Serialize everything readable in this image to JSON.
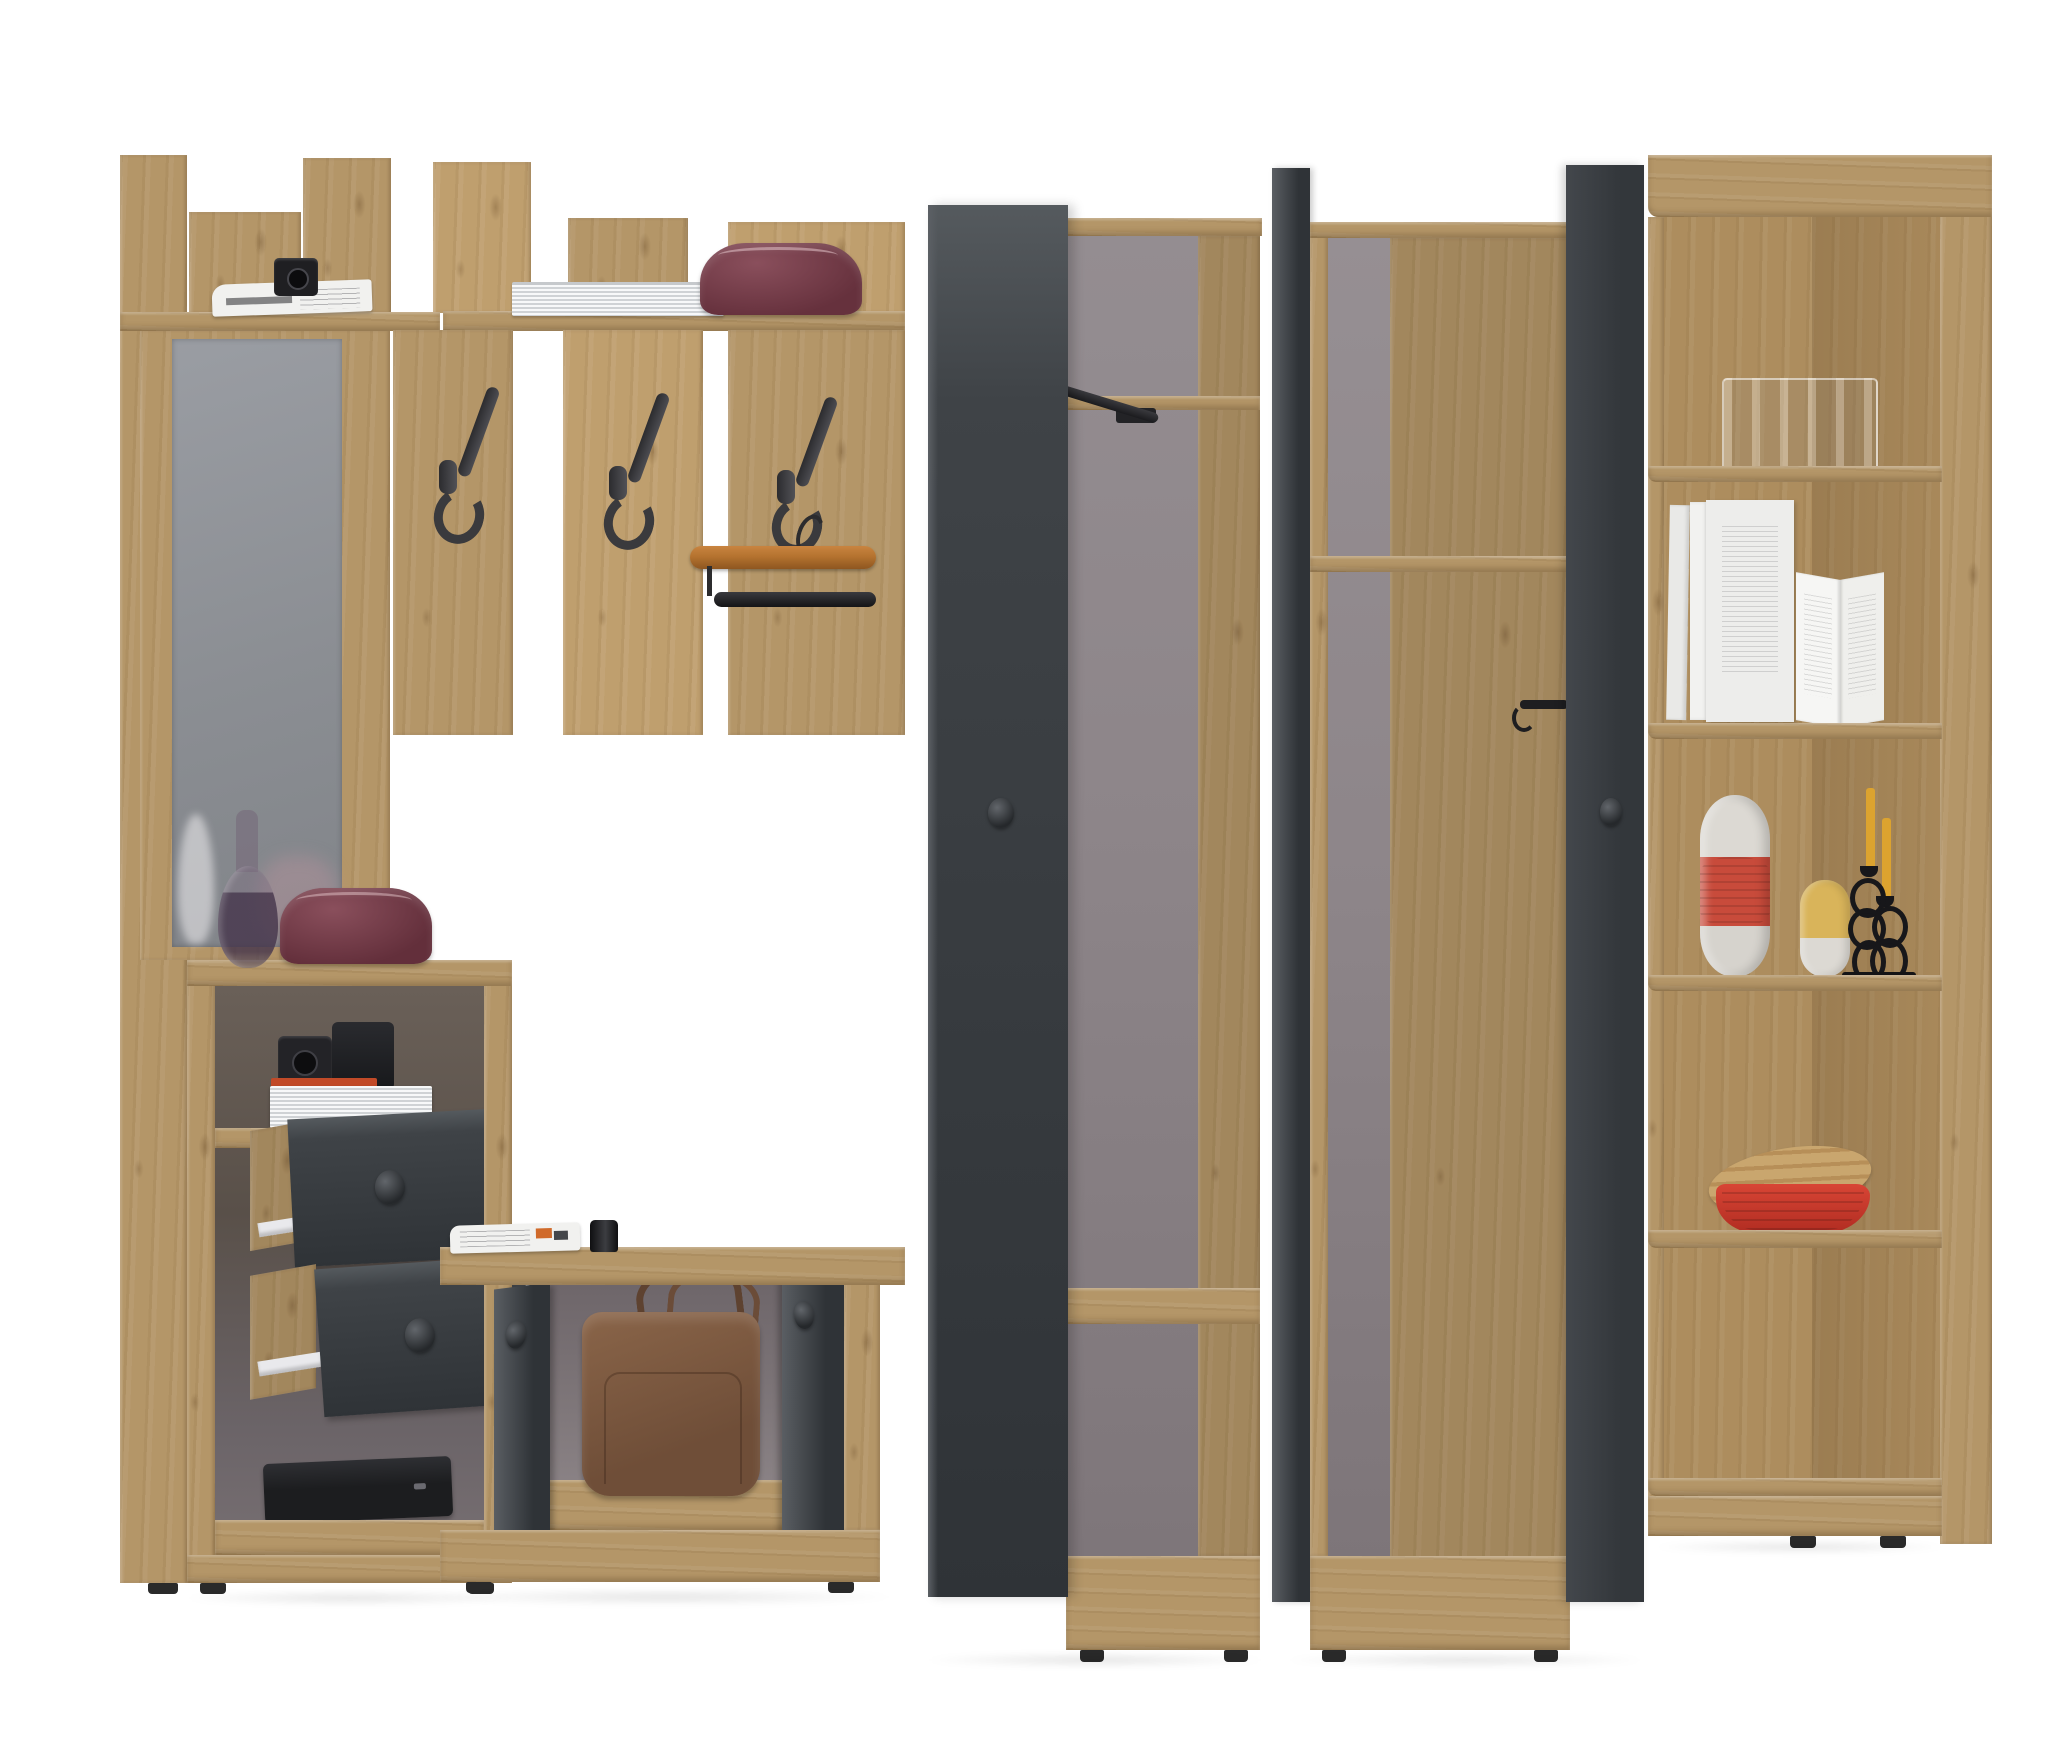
{
  "scene": {
    "subject": "Product render of a hallway furniture set in artisan oak and graphite gray on a white background",
    "groups": [
      {
        "name": "coat-rack-wall",
        "items": [
          "tall-side-panel",
          "two-wall-shelves",
          "mirror",
          "three-black-coat-hooks",
          "wooden-trouser-hanger",
          "folded-newspaper",
          "black-camera",
          "thick-white-book",
          "burgundy-leather-pouch"
        ]
      },
      {
        "name": "drawer-cabinet",
        "items": [
          "open-cubby-with-two-black-cameras",
          "orange-book",
          "white-book",
          "two-open-graphite-drawers-with-white-runners",
          "black-laptop-bag",
          "smoky-glass-vase",
          "burgundy-leather-pouch"
        ]
      },
      {
        "name": "shoe-bench",
        "items": [
          "folded-newspaper",
          "black-flask",
          "two-open-graphite-doors",
          "brown-leather-handbag"
        ]
      },
      {
        "name": "tall-wardrobe-open",
        "items": [
          "graphite-door-with-knob",
          "interior-shelf",
          "black-pull-out-clothes-rail",
          "bottom-shelf"
        ]
      },
      {
        "name": "corner-wardrobe-open",
        "items": [
          "edge-on-graphite-door",
          "graphite-door-with-knob",
          "interior-shelf",
          "black-wall-hook"
        ]
      },
      {
        "name": "corner-shelf-unit",
        "items": [
          "glass-vase",
          "white-books",
          "standing-open-book",
          "white-red-striped-vase",
          "yellow-white-vase",
          "black-loop-candelabra",
          "two-yellow-candles",
          "red-bamboo-bowl-with-wooden-lid"
        ]
      }
    ]
  },
  "palette": {
    "background": "#ffffff",
    "oak": "#b49668",
    "oak_light": "#c7ab7d",
    "oak_dark": "#93764c",
    "oak_interior": "#9c7f53",
    "graphite": "#3f4347",
    "graphite_light": "#555a5e",
    "graphite_dark": "#2f3337",
    "interior_gray": "#8d8589",
    "interior_gray_dark": "#6b6066",
    "mirror_gray": "#8f9297",
    "metal": "#38383b",
    "paper": "#f1f1ef",
    "burgundy": "#6f3b45",
    "bag_brown": "#7d5a42",
    "hanger_wood": "#b5732f",
    "vase_red": "#c84b3b",
    "vase_yellow": "#d9b45a",
    "candle": "#dca32f",
    "bowl_red": "#ce3a2c",
    "book_orange": "#c14a28",
    "laptop_black": "#1c1d1f",
    "rail_white": "#e9e9ec",
    "foot_black": "#2a2a2a"
  }
}
